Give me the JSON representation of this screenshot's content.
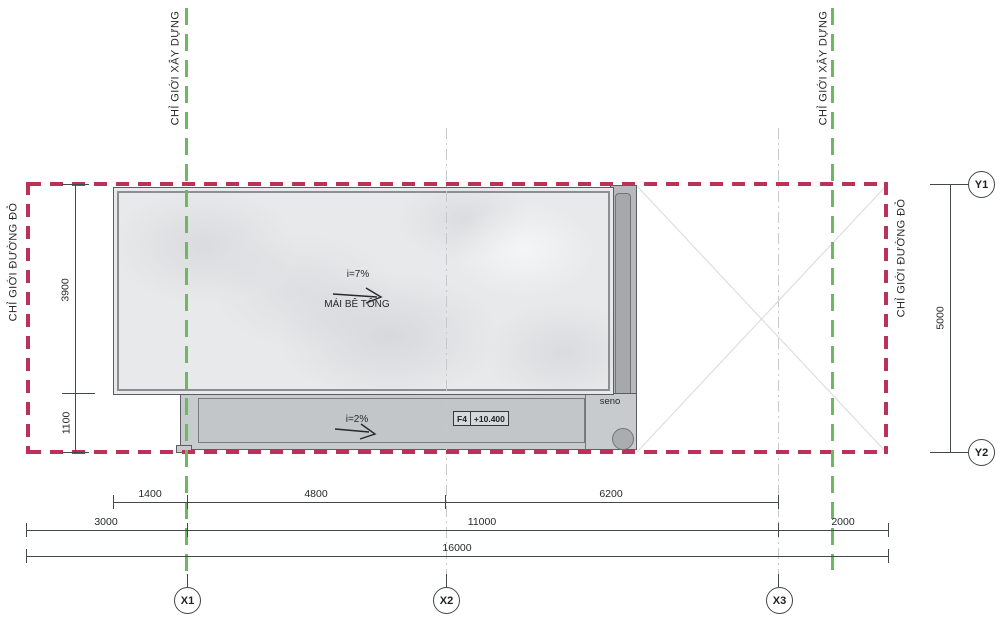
{
  "drawing": {
    "boundaries": {
      "construction_left": "CHỈ GIỚI XÂY DỰNG",
      "construction_right": "CHỈ GIỚI XÂY DỰNG",
      "red_line_left": "CHỈ GIỚI ĐƯỜNG ĐỎ",
      "red_line_right": "CHỈ GIỚI ĐƯỜNG ĐỎ"
    },
    "roof": {
      "slope_main": "i=7%",
      "material": "MÁI BÊ TÔNG",
      "slope_terrace": "i=2%",
      "gutter_label": "seno",
      "level_tag": "F4",
      "level_value": "+10.400"
    },
    "grid_bubbles": {
      "x1": "X1",
      "x2": "X2",
      "x3": "X3",
      "y1": "Y1",
      "y2": "Y2"
    },
    "dimensions": {
      "left_top": "3900",
      "left_bottom": "1100",
      "right": "5000",
      "row1": [
        "1400",
        "4800",
        "6200"
      ],
      "row2": [
        "3000",
        "11000",
        "2000"
      ],
      "row3": [
        "16000"
      ]
    },
    "colors": {
      "red_boundary": "#bb3157",
      "green_boundary": "#6cb95f",
      "line": "#43484b",
      "slab_fill": "#e8e9eb",
      "terrace_fill": "#c8cbcd",
      "gutter_fill": "#b5b9bb"
    }
  }
}
